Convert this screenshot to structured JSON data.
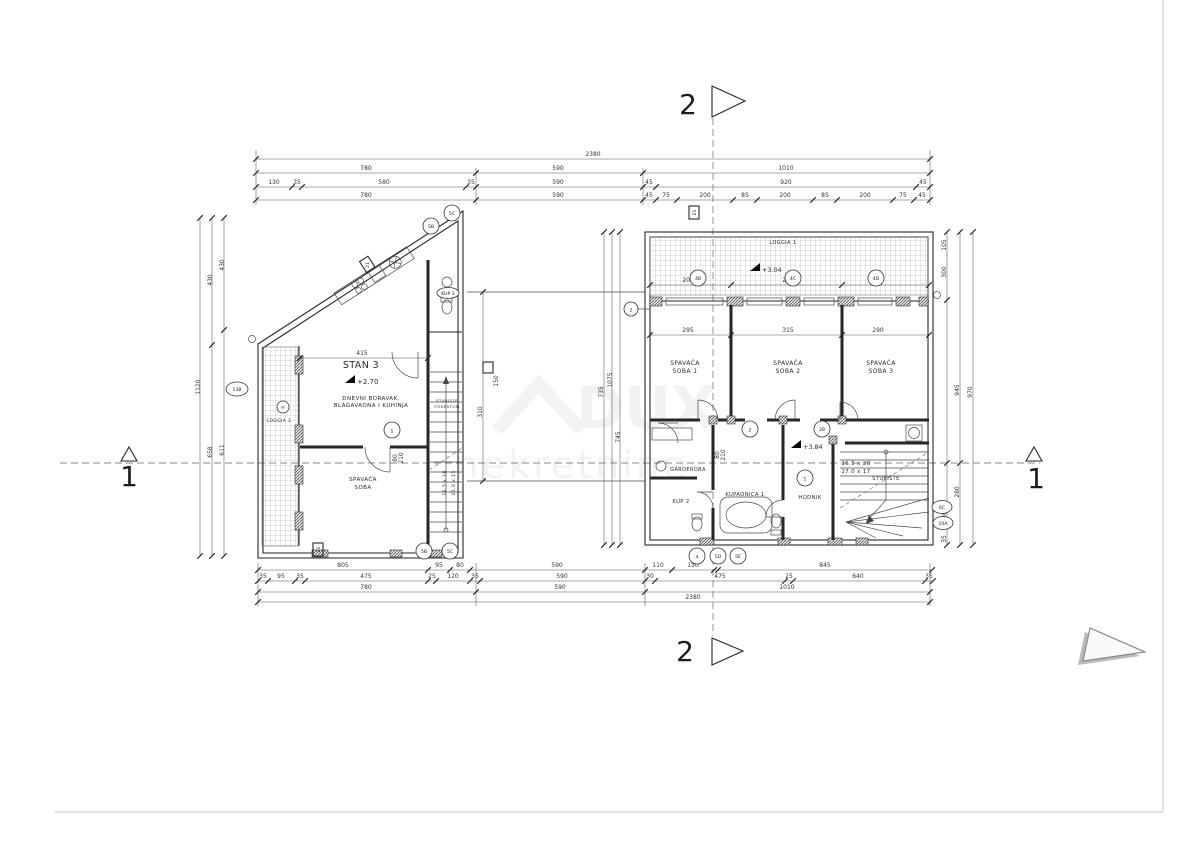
{
  "page": {
    "watermark_line1": "DUX",
    "watermark_line2": "nekretnine"
  },
  "sections": {
    "top": "2",
    "bottom": "2",
    "left": "1",
    "right": "1"
  },
  "left_plan": {
    "title": "STAN 3",
    "level": "+2.70",
    "living_line1": "DNEVNI BORAVAK,",
    "living_line2": "BLAGAVAONA I KUHINJA",
    "bedroom_line1": "SPAVAĆA",
    "bedroom_line2": "SOBA",
    "loggia": "LOGGIA 3",
    "stairs_line1": "STUBIŠTE",
    "stairs_line2": "PODESTOM",
    "stair_steps_1": "16.5 x 16",
    "stair_steps_2": "25.0 x 15",
    "wc": "KUP 3"
  },
  "right_plan": {
    "loggia": "LOGGIA 1",
    "loggia_level": "+3.04",
    "level": "+3.84",
    "bedroom1_line1": "SPAVAĆA",
    "bedroom1_line2": "SOBA 1",
    "bedroom2_line1": "SPAVAĆA",
    "bedroom2_line2": "SOBA 2",
    "bedroom3_line1": "SPAVAĆA",
    "bedroom3_line2": "SOBA 3",
    "wardrobe": "GARDEROBA",
    "bath2": "KUP 2",
    "bath1": "KUPAONICA 1",
    "hall": "HODNIK",
    "stairs": "STUBIŠTE",
    "stair_steps_1": "16.5 x 20",
    "stair_steps_2": "27.0 x 17"
  },
  "bubbles": {
    "b1": "1",
    "b2": "2",
    "b2B": "2B",
    "b4": "4",
    "b4B": "4B",
    "b4C": "4C",
    "b4D": "4D",
    "b5B": "5B",
    "b5C": "5C",
    "b5D": "5D",
    "b5E": "5E",
    "b6C": "6C",
    "b10A": "10A",
    "b13B": "13B",
    "bH": "H",
    "box21": "21"
  },
  "door_tag": {
    "width": "80",
    "height": "210"
  },
  "dims": {
    "top": [
      [
        "2380"
      ],
      [
        "780",
        "590",
        "1010"
      ],
      [
        "130",
        "35",
        "580",
        "35",
        "590",
        "45",
        "920",
        "45"
      ],
      [
        "780",
        "590",
        "45",
        "75",
        "200",
        "85",
        "200",
        "85",
        "200",
        "75",
        "45"
      ]
    ],
    "bottom": [
      [
        "805",
        "95",
        "80",
        "590",
        "110",
        "150",
        "845"
      ],
      [
        "35",
        "95",
        "35",
        "475",
        "25",
        "120",
        "35",
        "590",
        "30",
        "475",
        "25",
        "640",
        "35"
      ],
      [
        "780",
        "590",
        "1010"
      ],
      [
        "2380"
      ]
    ],
    "left": [
      "1120",
      "430",
      "658",
      "430",
      "611"
    ],
    "mid": [
      "310",
      "735",
      "1075",
      "745",
      "150"
    ],
    "right": [
      "300",
      "105",
      "80",
      "35",
      "945",
      "280",
      "970"
    ],
    "inner_rw": [
      "295",
      "315",
      "290"
    ],
    "inner_rt": [
      "200",
      "200",
      "200"
    ],
    "inner_l": [
      "415"
    ]
  }
}
